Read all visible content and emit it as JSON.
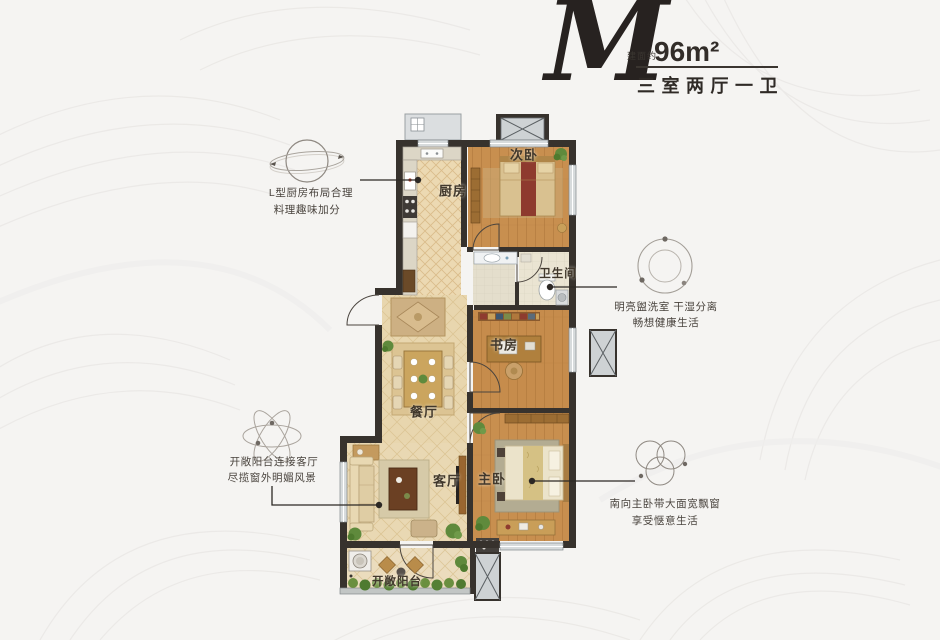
{
  "title": {
    "letter": "M",
    "area_label": "建面约",
    "area_value": "96m²",
    "type_line": "三室两厅一卫"
  },
  "rooms": {
    "kitchen": "厨房",
    "bedroom2": "次卧",
    "bathroom": "卫生间",
    "study": "书房",
    "dining": "餐厅",
    "living": "客厅",
    "master": "主卧",
    "balcony": "开敞阳台"
  },
  "annotations": [
    {
      "icon": "saturn-orbit-icon",
      "line1": "L型厨房布局合理",
      "line2": "料理趣味加分"
    },
    {
      "icon": "orbit-dots-icon",
      "line1": "明亮盥洗室 干湿分离",
      "line2": "畅想健康生活"
    },
    {
      "icon": "atom-orbits-icon",
      "line1": "开敞阳台连接客厅",
      "line2": "尽揽窗外明媚风景"
    },
    {
      "icon": "triple-circles-icon",
      "line1": "南向主卧带大面宽飘窗",
      "line2": "享受惬意生活"
    }
  ],
  "palette": {
    "wall": "#37322d",
    "wood_floor": "#c78e4e",
    "tile_floor": "#e8d6ae",
    "accent_red": "#8e3a2e",
    "plant_green": "#5f8a3c",
    "text_dark": "#2f2a26",
    "leader_line": "#2c2824",
    "background": "#f5f4f2"
  }
}
